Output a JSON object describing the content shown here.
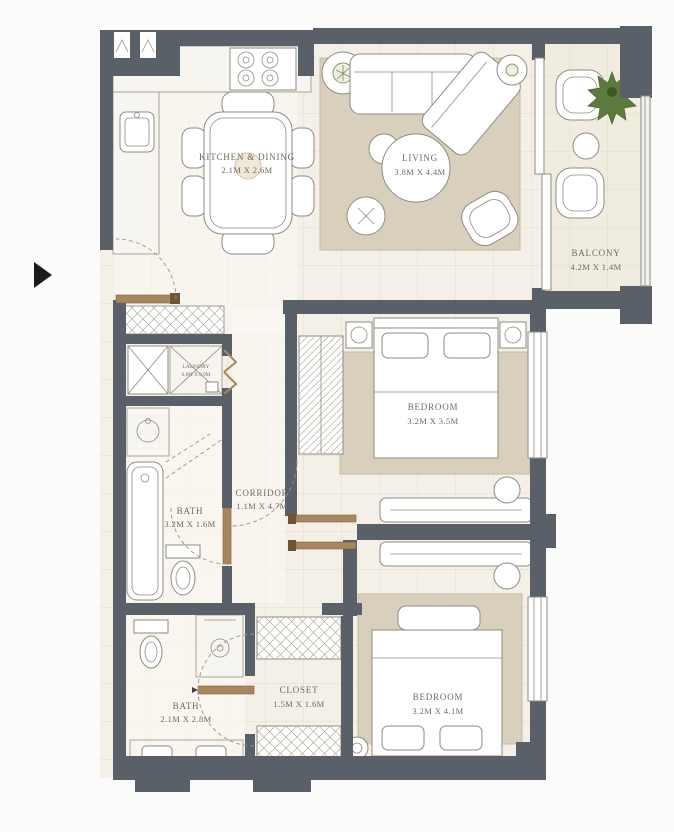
{
  "plan": {
    "title": "apartment-floor-plan-2-bedroom",
    "colors": {
      "wall": "#596068",
      "floor": "#f4f0e7",
      "floor_light": "#faf8f3",
      "rug": "#d8d0bc",
      "wood_door": "#a8875f",
      "plant": "#5d7a3e",
      "label_text": "#6f6a5f"
    },
    "entry_marker": "right-arrow",
    "rooms": {
      "kitchen_dining": {
        "name": "KITCHEN & DINING",
        "dims": "2.1M X 2.6M"
      },
      "living": {
        "name": "LIVING",
        "dims": "3.8M X 4.4M"
      },
      "balcony": {
        "name": "BALCONY",
        "dims": "4.2M X 1.4M"
      },
      "bedroom1": {
        "name": "BEDROOM",
        "dims": "3.2M X 3.5M"
      },
      "corridor": {
        "name": "CORRIDOR",
        "dims": "1.1M X 4.7M"
      },
      "bath1": {
        "name": "BATH",
        "dims": "3.2M X 1.6M"
      },
      "laundry": {
        "name": "LAUNDRY",
        "dims": "0.8M X 0.9M"
      },
      "closet": {
        "name": "CLOSET",
        "dims": "1.5M X 1.6M"
      },
      "bath2": {
        "name": "BATH",
        "dims": "2.1M X 2.8M"
      },
      "bedroom2": {
        "name": "BEDROOM",
        "dims": "3.2M X 4.1M"
      }
    }
  }
}
